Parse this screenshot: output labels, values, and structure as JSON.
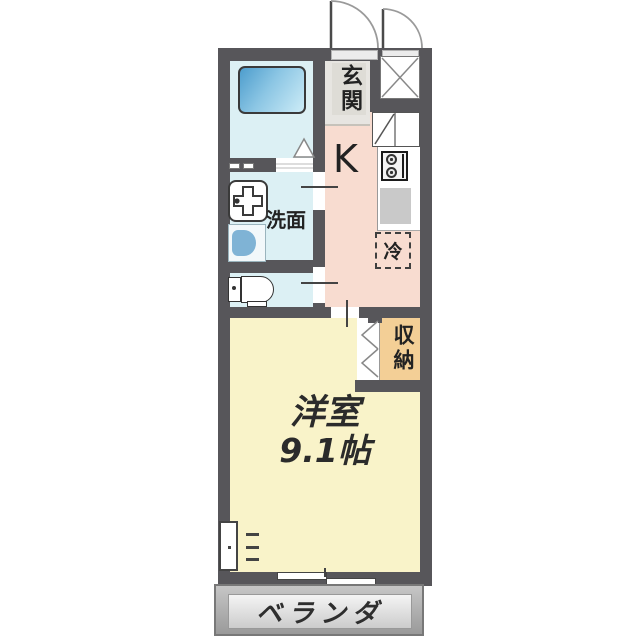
{
  "rooms": {
    "entrance": "玄関",
    "kitchen": "K",
    "washroom": "洗面",
    "refrigerator": "冷",
    "storage": "収納",
    "western_room": "洋室",
    "western_room_size": "9.1帖",
    "veranda": "ベランダ"
  },
  "colors": {
    "wall": "#57565a",
    "bath_floor": "#dcf0f4",
    "tub_a": "#4d9dcd",
    "tub_b": "#cdecf7",
    "kitchen_floor": "#f8dcd0",
    "entrance_floor": "#e7e5e1",
    "room_floor": "#f9f3c9",
    "storage_fill": "#f3cf96",
    "washer_blue": "#7fb3d5",
    "veranda_a": "#c6c6c6",
    "veranda_b": "#9a9a9a",
    "veranda_panel_a": "#f4f4f4",
    "veranda_panel_b": "#cccccc",
    "sink_gray": "#c9c9c9"
  }
}
